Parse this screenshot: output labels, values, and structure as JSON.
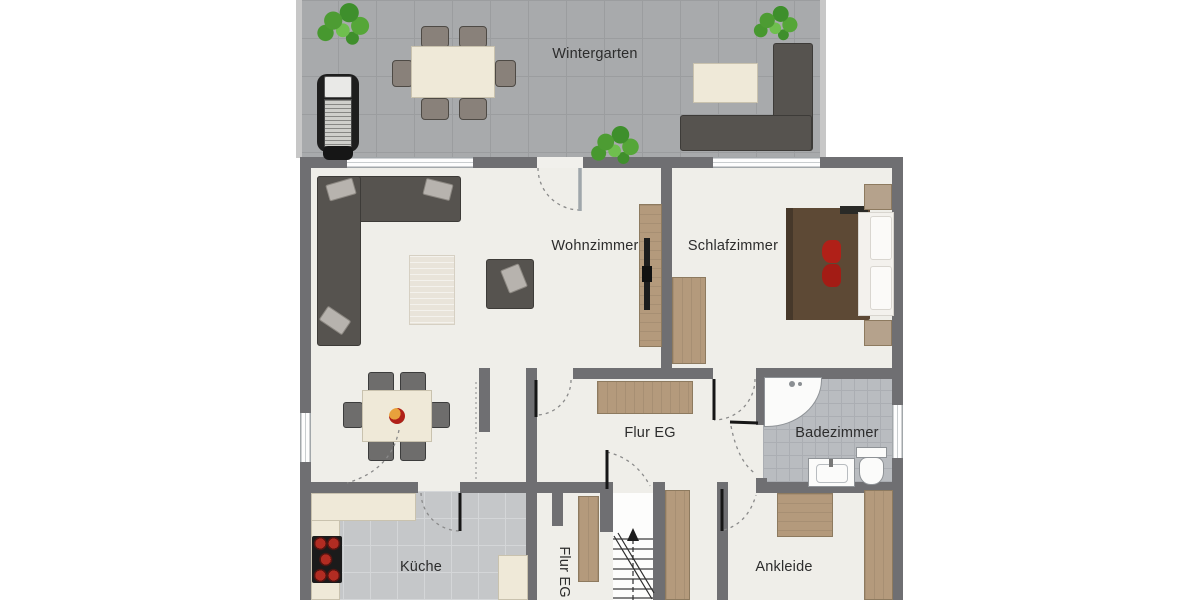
{
  "rooms": {
    "wintergarten": {
      "label": "Wintergarten"
    },
    "wohnzimmer": {
      "label": "Wohnzimmer"
    },
    "schlafzimmer": {
      "label": "Schlafzimmer"
    },
    "flur": {
      "label": "Flur EG"
    },
    "badezimmer": {
      "label": "Badezimmer"
    },
    "kueche": {
      "label": "Küche"
    },
    "flur_treppe": {
      "label": "Flur EG"
    },
    "ankleide": {
      "label": "Ankleide"
    }
  },
  "furniture": {
    "wintergarten": [
      "plant",
      "grill",
      "dining-table",
      "chair x6",
      "side-table",
      "corner-sofa"
    ],
    "wohnzimmer": [
      "sectional-sofa",
      "cushions",
      "rug",
      "armchair",
      "tv-lowboard",
      "tv"
    ],
    "essbereich": [
      "dining-table",
      "chair x6",
      "fruit-bowl"
    ],
    "schlafzimmer": [
      "double-bed",
      "pillows",
      "red-cushions",
      "nightstand x2",
      "wardrobe"
    ],
    "badezimmer": [
      "corner-shower",
      "sink",
      "toilet"
    ],
    "kueche": [
      "countertop",
      "cooktop"
    ],
    "flur": [
      "sideboard"
    ],
    "treppenhaus": [
      "staircase",
      "closet x2"
    ],
    "ankleide": [
      "wardrobe x2"
    ]
  },
  "colors": {
    "wall": "#6f6f72",
    "floor": "#efeee9",
    "tile_conservatory": "#a8aaac",
    "tile_kitchen": "#c5c7c9",
    "tile_bath": "#b9bcc0",
    "wood": "#b49a7c",
    "upholstery": "#56534f",
    "bed_blanket": "#5d4935",
    "accent_red": "#b02018",
    "counter": "#efe9d8",
    "plant_green": "#4d9c33"
  }
}
